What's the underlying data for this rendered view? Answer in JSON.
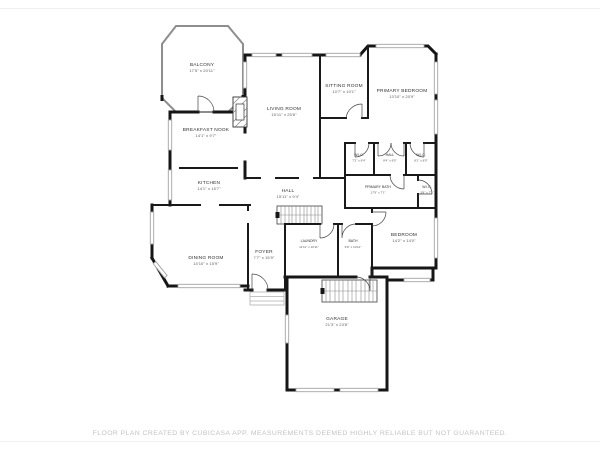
{
  "colors": {
    "wall": "#161616",
    "window_stroke": "#a3a3a3",
    "balcony_outline": "#8e8e8e",
    "stair_stroke": "#555555",
    "label_text": "#303030",
    "dims_text": "#5c5c5c",
    "disclaimer_text": "#c3c3c3",
    "background": "#ffffff"
  },
  "rooms": [
    {
      "name": "BALCONY",
      "dims": "17'5\" x 20'11\""
    },
    {
      "name": "BREAKFAST NOOK",
      "dims": "14'1\" x 9'7\""
    },
    {
      "name": "KITCHEN",
      "dims": "14'1\" x 15'7\""
    },
    {
      "name": "DINING ROOM",
      "dims": "14'10\" x 15'9\""
    },
    {
      "name": "LIVING ROOM",
      "dims": "15'11\" x 25'8\""
    },
    {
      "name": "SITTING ROOM",
      "dims": "10'7\" x 10'1\""
    },
    {
      "name": "PRIMARY BEDROOM",
      "dims": "13'10\" x 20'9\""
    },
    {
      "name": "W.I.C.",
      "dims": "7'2\" x 8'4\""
    },
    {
      "name": "HALL",
      "dims": "8'4\" x 8'5\""
    },
    {
      "name": "W.I.C.",
      "dims": "8'1\" x 8'5\""
    },
    {
      "name": "PRIMARY BATH",
      "dims": "17'9\" x 7'1\""
    },
    {
      "name": "W.I.C.",
      "dims": "3'8\" x 7'1\""
    },
    {
      "name": "HALL",
      "dims": "15'11\" x 9'4\""
    },
    {
      "name": "LAUNDRY",
      "dims": "11'11\" x 10'11\""
    },
    {
      "name": "BATH",
      "dims": "9'9\" x 10'11\""
    },
    {
      "name": "BEDROOM",
      "dims": "14'2\" x 14'0\""
    },
    {
      "name": "FOYER",
      "dims": "7'7\" x 15'9\""
    },
    {
      "name": "GARAGE",
      "dims": "21'3\" x 23'8\""
    }
  ],
  "footer": {
    "disclaimer": "FLOOR PLAN CREATED BY CUBICASA APP. MEASUREMENTS DEEMED HIGHLY RELIABLE BUT NOT GUARANTEED."
  }
}
